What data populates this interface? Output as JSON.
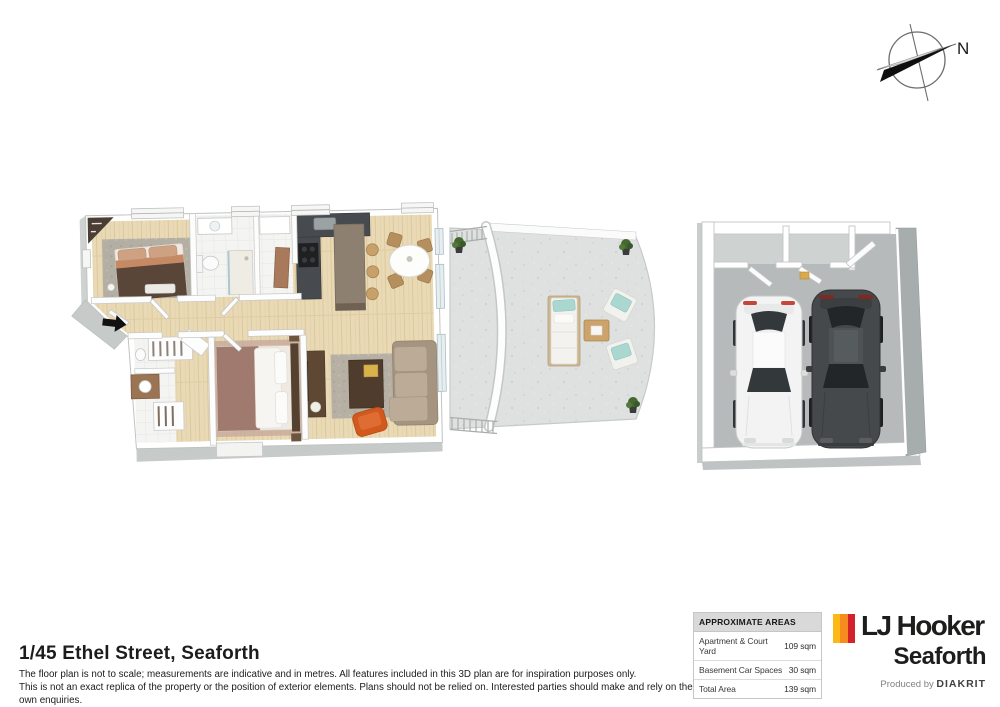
{
  "title": "1/45 Ethel Street, Seaforth",
  "disclaimer": {
    "line1": "The floor plan is not to scale; measurements are indicative and in metres. All features included in this 3D plan are for inspiration purposes only.",
    "line2": "This is not an exact replica of the property or the position of exterior elements. Plans should not be relied on. Interested parties should make and rely on their own enquiries."
  },
  "areas_table": {
    "header": "APPROXIMATE AREAS",
    "rows": [
      {
        "label": "Apartment & Court Yard",
        "value": "109 sqm"
      },
      {
        "label": "Basement Car Spaces",
        "value": "30 sqm"
      },
      {
        "label": "Total Area",
        "value": "139 sqm"
      }
    ]
  },
  "branding": {
    "brand": "LJ Hooker",
    "office": "Seaforth",
    "produced_by": "Produced by",
    "producer": "DIAKRIT",
    "stripe_colors": [
      "#FDB913",
      "#F68B1F",
      "#D2232A"
    ]
  },
  "compass": {
    "label": "N"
  },
  "palette": {
    "wood_floor": "#e9d9b5",
    "walls": "#ffffff",
    "wall_shadow": "#c6cac9",
    "tile_floor": "#f4f5f3",
    "courtyard_paving": "#dfe1e0",
    "garage_floor": "#b7babb",
    "kitchen_counter": "#474b4f",
    "kitchen_island": "#8e8071",
    "sofa": "#b3a28f",
    "armchair_orange": "#d2591d",
    "master_bed": "#a17a6f",
    "second_bed": "#594639",
    "outdoor_cushion": "#abd7d1",
    "car_white": "#f2f3f2",
    "car_dark": "#46494c",
    "plant_green": "#44682f"
  }
}
